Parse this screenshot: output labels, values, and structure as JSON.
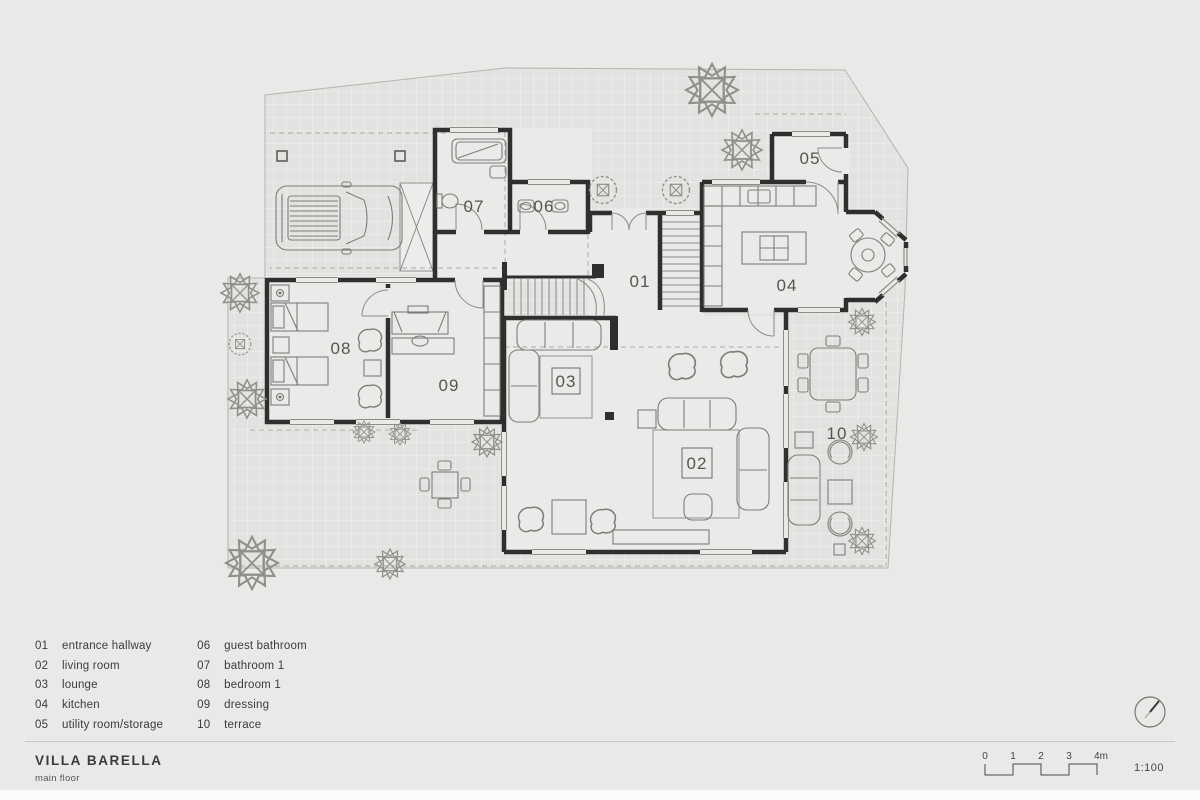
{
  "project": {
    "title": "VILLA BARELLA",
    "subtitle": "main floor"
  },
  "rooms": [
    {
      "number": "01",
      "name": "entrance hallway"
    },
    {
      "number": "02",
      "name": "living room"
    },
    {
      "number": "03",
      "name": "lounge"
    },
    {
      "number": "04",
      "name": "kitchen"
    },
    {
      "number": "05",
      "name": "utility room/storage"
    },
    {
      "number": "06",
      "name": "guest bathroom"
    },
    {
      "number": "07",
      "name": "bathroom 1"
    },
    {
      "number": "08",
      "name": "bedroom 1"
    },
    {
      "number": "09",
      "name": "dressing"
    },
    {
      "number": "10",
      "name": "terrace"
    }
  ],
  "scale_bar": {
    "ticks": [
      "0",
      "1",
      "2",
      "3",
      "4m"
    ],
    "ratio": "1:100"
  },
  "icons": {
    "compass": "north-compass-icon",
    "tree": "tree-icon"
  },
  "colors": {
    "background": "#e9e9e8",
    "paving": "#e2e2e0",
    "wall": "#2f2f2d",
    "furniture_line": "#7d7d7a",
    "dashed_line": "#a9a9a6",
    "text": "#3b3b39"
  }
}
